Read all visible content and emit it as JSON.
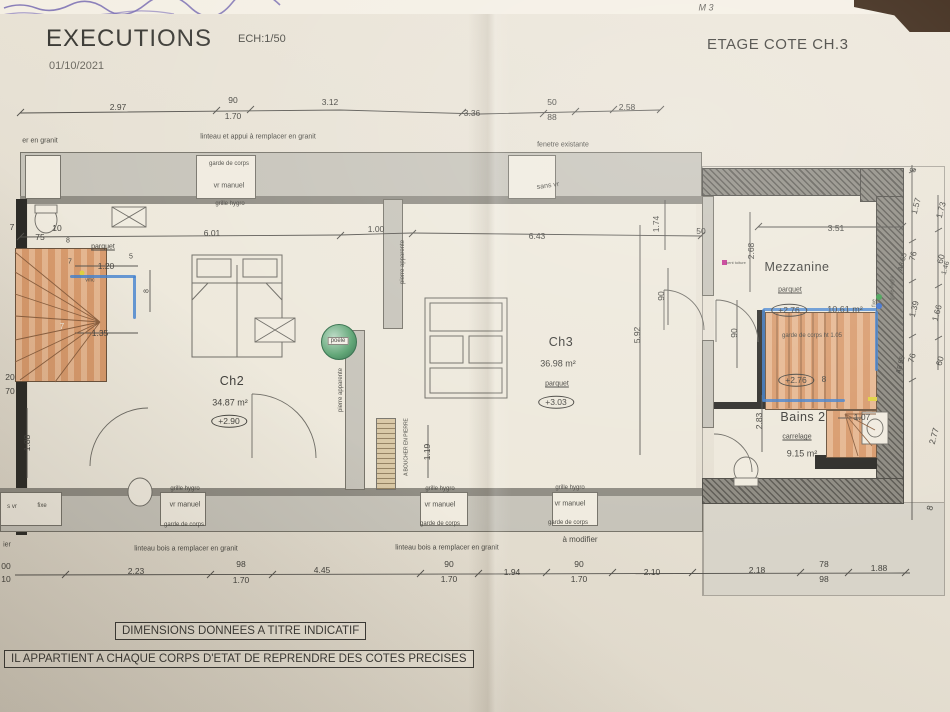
{
  "header": {
    "title": "EXECUTIONS",
    "scale": "ECH:1/50",
    "date": "01/10/2021",
    "sheet": "ETAGE COTE CH.3"
  },
  "notes": {
    "note1": "DIMENSIONS DONNEES A TITRE INDICATIF",
    "note2": "IL APPARTIENT A CHAQUE CORPS D'ETAT DE REPRENDRE DES COTES PRECISES"
  },
  "rooms": [
    {
      "name": "Ch2",
      "area": "34.87 m²",
      "level": "+2.90",
      "floor": "parquet"
    },
    {
      "name": "Ch3",
      "area": "36.98 m²",
      "level": "+3.03",
      "floor": "parquet"
    },
    {
      "name": "Mezzanine",
      "area": "10.61 m²",
      "level": "+2.76",
      "floor": "parquet"
    },
    {
      "name": "Bains 2",
      "area": "9.15 m²",
      "level": "+2.76",
      "floor": "carrelage"
    }
  ],
  "colors": {
    "paper": "#e7e1d4",
    "marker_blue": "#3f7fd0",
    "stairs_orange": "#d89a6c",
    "poele_green": "#57a06e",
    "line": "#55534e",
    "dark_corner": "#35200f"
  },
  "annotations": [
    {
      "t": "2.97",
      "x": 118,
      "y": 107
    },
    {
      "t": "90",
      "x": 233,
      "y": 100
    },
    {
      "t": "1.70",
      "x": 233,
      "y": 116
    },
    {
      "t": "3.12",
      "x": 330,
      "y": 102
    },
    {
      "t": "3.36",
      "x": 472,
      "y": 113
    },
    {
      "t": "50",
      "x": 552,
      "y": 102
    },
    {
      "t": "88",
      "x": 552,
      "y": 117
    },
    {
      "t": "2.58",
      "x": 627,
      "y": 107
    },
    {
      "t": "er en granit",
      "x": 40,
      "y": 141,
      "c": "lbl"
    },
    {
      "t": "linteau et appui à remplacer en granit",
      "x": 258,
      "y": 137,
      "c": "lbl"
    },
    {
      "t": "fenetre existante",
      "x": 563,
      "y": 145,
      "c": "lbl"
    },
    {
      "t": "garde de corps",
      "x": 229,
      "y": 164,
      "c": "lbl",
      "fs": 6
    },
    {
      "t": "vr manuel",
      "x": 229,
      "y": 186,
      "c": "lbl"
    },
    {
      "t": "grille hygro",
      "x": 230,
      "y": 204,
      "c": "lbl",
      "fs": 6
    },
    {
      "t": "sans vr",
      "x": 548,
      "y": 186,
      "c": "lbl",
      "r": -8
    },
    {
      "t": "7",
      "x": 12,
      "y": 227
    },
    {
      "t": "75",
      "x": 40,
      "y": 237
    },
    {
      "t": "10",
      "x": 57,
      "y": 228
    },
    {
      "t": "8",
      "x": 68,
      "y": 241,
      "fs": 7
    },
    {
      "t": "6.01",
      "x": 212,
      "y": 233
    },
    {
      "t": "1.00",
      "x": 376,
      "y": 229
    },
    {
      "t": "6.43",
      "x": 537,
      "y": 236
    },
    {
      "t": "1.74",
      "x": 656,
      "y": 224,
      "r": -90
    },
    {
      "t": "50",
      "x": 701,
      "y": 231
    },
    {
      "t": "3.51",
      "x": 836,
      "y": 228
    },
    {
      "t": "2.68",
      "x": 751,
      "y": 251,
      "r": -90
    },
    {
      "t": "parquet",
      "x": 103,
      "y": 247,
      "c": "strike"
    },
    {
      "t": "7",
      "x": 70,
      "y": 262,
      "fs": 7
    },
    {
      "t": "1.20",
      "x": 106,
      "y": 266
    },
    {
      "t": "5",
      "x": 131,
      "y": 257,
      "fs": 7
    },
    {
      "t": "vmc",
      "x": 90,
      "y": 281,
      "c": "lbl",
      "fs": 5
    },
    {
      "t": "8",
      "x": 147,
      "y": 291,
      "r": -90,
      "fs": 7
    },
    {
      "t": "1.35",
      "x": 100,
      "y": 333
    },
    {
      "t": "7",
      "x": 62,
      "y": 327,
      "c": "dimw"
    },
    {
      "t": "20",
      "x": 10,
      "y": 377
    },
    {
      "t": "70",
      "x": 10,
      "y": 391
    },
    {
      "t": "1.88",
      "x": 27,
      "y": 443,
      "r": -90
    },
    {
      "t": "s vr",
      "x": 12,
      "y": 507,
      "c": "lbl",
      "fs": 6
    },
    {
      "t": "fixe",
      "x": 42,
      "y": 506,
      "c": "lbl",
      "fs": 6
    },
    {
      "t": "ier",
      "x": 7,
      "y": 545,
      "c": "lbl"
    },
    {
      "t": "00",
      "x": 6,
      "y": 566
    },
    {
      "t": "10",
      "x": 6,
      "y": 579
    },
    {
      "t": "Ch2",
      "x": 232,
      "y": 381,
      "c": "room"
    },
    {
      "t": "34.87 m²",
      "x": 230,
      "y": 403,
      "c": "area"
    },
    {
      "t": "+2.90",
      "x": 229,
      "y": 421,
      "c": "oval"
    },
    {
      "t": "poele",
      "x": 338,
      "y": 341,
      "c": "poele-lbl"
    },
    {
      "t": "pierre apparente",
      "x": 341,
      "y": 390,
      "r": -90,
      "c": "lbl",
      "fs": 6
    },
    {
      "t": "pierre apparente",
      "x": 403,
      "y": 262,
      "r": -90,
      "c": "lbl",
      "fs": 6
    },
    {
      "t": "A BOUCHER EN PIERRE",
      "x": 407,
      "y": 447,
      "r": -90,
      "c": "lbl",
      "fs": 5
    },
    {
      "t": "1.19",
      "x": 427,
      "y": 452,
      "r": -90
    },
    {
      "t": "Ch3",
      "x": 561,
      "y": 342,
      "c": "room"
    },
    {
      "t": "36.98 m²",
      "x": 558,
      "y": 364,
      "c": "area"
    },
    {
      "t": "parquet",
      "x": 557,
      "y": 384,
      "c": "strike"
    },
    {
      "t": "+3.03",
      "x": 556,
      "y": 402,
      "c": "oval"
    },
    {
      "t": "5.92",
      "x": 637,
      "y": 335,
      "r": -90
    },
    {
      "t": "90",
      "x": 661,
      "y": 296,
      "r": -90
    },
    {
      "t": "90",
      "x": 734,
      "y": 333,
      "r": -90
    },
    {
      "t": "Mezzanine",
      "x": 797,
      "y": 267,
      "c": "room"
    },
    {
      "t": "parquet",
      "x": 790,
      "y": 290,
      "c": "strike"
    },
    {
      "t": "+2.76",
      "x": 789,
      "y": 310,
      "c": "oval"
    },
    {
      "t": "10.61 m²",
      "x": 845,
      "y": 310,
      "c": "area"
    },
    {
      "t": "garde de corps ht 1.05",
      "x": 812,
      "y": 336,
      "c": "lbl",
      "fs": 6
    },
    {
      "t": "vent toiture",
      "x": 736,
      "y": 263,
      "c": "lbl",
      "fs": 4
    },
    {
      "t": "fixe",
      "x": 875,
      "y": 303,
      "r": -90,
      "c": "lbl",
      "fs": 5
    },
    {
      "t": "grille hygro",
      "x": 893,
      "y": 288,
      "r": -90,
      "c": "lbl",
      "fs": 5
    },
    {
      "t": "A8 55",
      "x": 903,
      "y": 262,
      "r": -75,
      "fs": 7
    },
    {
      "t": "A8 55",
      "x": 901,
      "y": 365,
      "r": -75,
      "fs": 7
    },
    {
      "t": "+2.76",
      "x": 796,
      "y": 380,
      "c": "oval"
    },
    {
      "t": "8",
      "x": 824,
      "y": 379
    },
    {
      "t": "Bains 2",
      "x": 803,
      "y": 417,
      "c": "room"
    },
    {
      "t": "carrelage",
      "x": 797,
      "y": 437,
      "c": "strike"
    },
    {
      "t": "9.15 m²",
      "x": 802,
      "y": 454,
      "c": "area"
    },
    {
      "t": "1.07",
      "x": 862,
      "y": 417
    },
    {
      "t": "2.83",
      "x": 759,
      "y": 421,
      "r": -90
    },
    {
      "t": "8",
      "x": 913,
      "y": 170,
      "r": -75
    },
    {
      "t": "1.57",
      "x": 916,
      "y": 206,
      "r": -75
    },
    {
      "t": "1.73",
      "x": 941,
      "y": 210,
      "r": -75
    },
    {
      "t": "76",
      "x": 913,
      "y": 256,
      "r": -75
    },
    {
      "t": "60",
      "x": 941,
      "y": 259,
      "r": -75
    },
    {
      "t": "1.46",
      "x": 946,
      "y": 268,
      "r": -75,
      "fs": 7
    },
    {
      "t": "1.39",
      "x": 914,
      "y": 309,
      "r": -75
    },
    {
      "t": "1.66",
      "x": 937,
      "y": 313,
      "r": -75
    },
    {
      "t": "76",
      "x": 912,
      "y": 358,
      "r": -75
    },
    {
      "t": "60",
      "x": 940,
      "y": 361,
      "r": -75
    },
    {
      "t": "2.77",
      "x": 934,
      "y": 436,
      "r": -75
    },
    {
      "t": "8",
      "x": 930,
      "y": 508,
      "r": -75
    },
    {
      "t": "grille hygro",
      "x": 185,
      "y": 489,
      "c": "lbl",
      "fs": 6
    },
    {
      "t": "vr manuel",
      "x": 185,
      "y": 505,
      "c": "lbl"
    },
    {
      "t": "garde de corps",
      "x": 184,
      "y": 525,
      "c": "lbl",
      "fs": 6
    },
    {
      "t": "grille hygro",
      "x": 440,
      "y": 489,
      "c": "lbl",
      "fs": 6
    },
    {
      "t": "vr manuel",
      "x": 440,
      "y": 505,
      "c": "lbl"
    },
    {
      "t": "garde de corps",
      "x": 440,
      "y": 524,
      "c": "lbl",
      "fs": 6
    },
    {
      "t": "grille hygro",
      "x": 570,
      "y": 488,
      "c": "lbl",
      "fs": 6
    },
    {
      "t": "vr manuel",
      "x": 570,
      "y": 504,
      "c": "lbl"
    },
    {
      "t": "garde de corps",
      "x": 568,
      "y": 523,
      "c": "lbl",
      "fs": 6
    },
    {
      "t": "linteau bois a remplacer en granit",
      "x": 186,
      "y": 549,
      "c": "lbl"
    },
    {
      "t": "linteau bois a remplacer en granit",
      "x": 447,
      "y": 548,
      "c": "lbl"
    },
    {
      "t": "à modifier",
      "x": 580,
      "y": 540,
      "c": "lbl",
      "fs": 8
    },
    {
      "t": "2.23",
      "x": 136,
      "y": 571
    },
    {
      "t": "98",
      "x": 241,
      "y": 564
    },
    {
      "t": "1.70",
      "x": 241,
      "y": 580
    },
    {
      "t": "4.45",
      "x": 322,
      "y": 570
    },
    {
      "t": "90",
      "x": 449,
      "y": 564
    },
    {
      "t": "1.70",
      "x": 449,
      "y": 579
    },
    {
      "t": "1.94",
      "x": 512,
      "y": 572
    },
    {
      "t": "90",
      "x": 579,
      "y": 564
    },
    {
      "t": "1.70",
      "x": 579,
      "y": 579
    },
    {
      "t": "2.10",
      "x": 652,
      "y": 572
    },
    {
      "t": "2.18",
      "x": 757,
      "y": 570
    },
    {
      "t": "78",
      "x": 824,
      "y": 564
    },
    {
      "t": "98",
      "x": 824,
      "y": 579
    },
    {
      "t": "1.88",
      "x": 879,
      "y": 568
    },
    {
      "t": "M 3",
      "x": 706,
      "y": 8,
      "c": "hand"
    }
  ]
}
